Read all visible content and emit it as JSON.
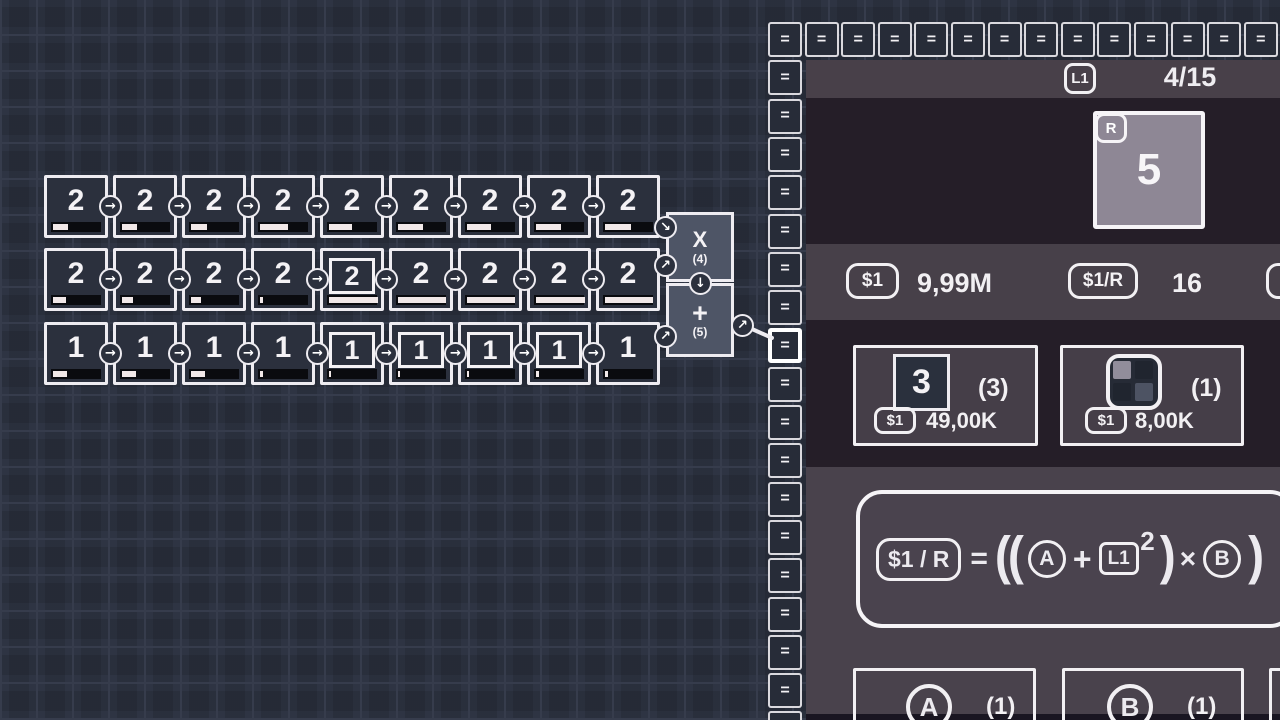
{
  "icons": {
    "arrow_right": "→",
    "arrow_up_right": "↗",
    "arrow_down_right": "↘",
    "arrow_down": "↓",
    "equals": "="
  },
  "grid": {
    "rows": [
      {
        "cells": [
          {
            "value": "2",
            "boxed": false,
            "progress": 30
          },
          {
            "value": "2",
            "boxed": false,
            "progress": 30
          },
          {
            "value": "2",
            "boxed": false,
            "progress": 32
          },
          {
            "value": "2",
            "boxed": false,
            "progress": 55
          },
          {
            "value": "2",
            "boxed": false,
            "progress": 45
          },
          {
            "value": "2",
            "boxed": false,
            "progress": 50
          },
          {
            "value": "2",
            "boxed": false,
            "progress": 48
          },
          {
            "value": "2",
            "boxed": false,
            "progress": 50
          },
          {
            "value": "2",
            "boxed": false,
            "progress": 52
          }
        ]
      },
      {
        "cells": [
          {
            "value": "2",
            "boxed": false,
            "progress": 25
          },
          {
            "value": "2",
            "boxed": false,
            "progress": 22
          },
          {
            "value": "2",
            "boxed": false,
            "progress": 20
          },
          {
            "value": "2",
            "boxed": false,
            "progress": 5
          },
          {
            "value": "2",
            "boxed": true,
            "progress": 97
          },
          {
            "value": "2",
            "boxed": false,
            "progress": 95
          },
          {
            "value": "2",
            "boxed": false,
            "progress": 96
          },
          {
            "value": "2",
            "boxed": false,
            "progress": 98
          },
          {
            "value": "2",
            "boxed": false,
            "progress": 95
          }
        ]
      },
      {
        "cells": [
          {
            "value": "1",
            "boxed": false,
            "progress": 28
          },
          {
            "value": "1",
            "boxed": false,
            "progress": 28
          },
          {
            "value": "1",
            "boxed": false,
            "progress": 28
          },
          {
            "value": "1",
            "boxed": false,
            "progress": 5
          },
          {
            "value": "1",
            "boxed": true,
            "progress": 4
          },
          {
            "value": "1",
            "boxed": true,
            "progress": 4
          },
          {
            "value": "1",
            "boxed": true,
            "progress": 4
          },
          {
            "value": "1",
            "boxed": true,
            "progress": 5
          },
          {
            "value": "1",
            "boxed": false,
            "progress": 5
          }
        ]
      }
    ],
    "multiply_box": {
      "label": "X",
      "count": "(4)"
    },
    "add_box": {
      "label": "+",
      "count": "(5)"
    }
  },
  "panel": {
    "equals_glyph": "=",
    "equals_row_count": 14,
    "equals_col_count": 18,
    "highlight_col_index": 8,
    "header": {
      "badge": "L1",
      "counter": "4/15"
    },
    "big_tile": {
      "badge": "R",
      "value": "5"
    },
    "stats": {
      "money_badge": "$1",
      "money": "9,99M",
      "rate_badge": "$1/R",
      "rate": "16"
    },
    "shop": [
      {
        "tile": "3",
        "count": "(3)",
        "price_badge": "$1",
        "price": "49,00K"
      },
      {
        "count": "(1)",
        "price_badge": "$1",
        "price": "8,00K"
      }
    ],
    "formula": {
      "lhs": "$1 / R",
      "eq": "=",
      "open": "((",
      "a": "A",
      "plus": "+",
      "base": "L1",
      "exp": "2",
      "close1": ")",
      "times": "×",
      "b": "B",
      "close2": ")"
    },
    "bottom_cards": [
      {
        "letter": "A",
        "count": "(1)"
      },
      {
        "letter": "B",
        "count": "(1)"
      }
    ]
  },
  "colors": {
    "grid_icon_tl": "#918d9b",
    "grid_icon_tr": "#20252f",
    "grid_icon_bl": "#20252f",
    "grid_icon_br": "#4d5363"
  }
}
